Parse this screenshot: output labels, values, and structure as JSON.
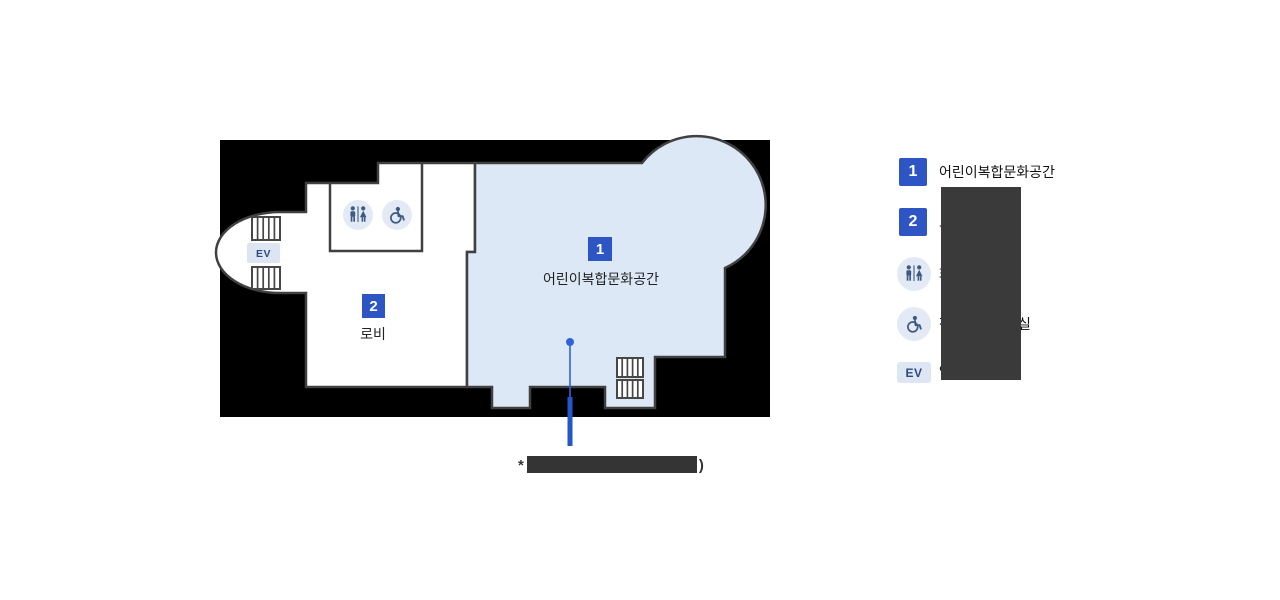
{
  "plan": {
    "area1": {
      "badge": "1",
      "label": "어린이복합문화공간"
    },
    "area2": {
      "badge": "2",
      "label": "로비"
    },
    "elevator_label": "EV"
  },
  "legend": {
    "items": [
      {
        "badge": "1",
        "label": "어린이복합문화공간"
      },
      {
        "badge": "2",
        "label_fragment": "로"
      },
      {
        "icon": "restroom-icon",
        "label_fragment": "화"
      },
      {
        "icon": "wheelchair-icon",
        "label_fragment": "장",
        "label_fragment_end": "실"
      },
      {
        "badge": "EV",
        "label_fragment": "엘"
      }
    ]
  },
  "annotation": {
    "prefix": "*",
    "suffix": ")"
  },
  "colors": {
    "accent": "#2d56c4",
    "wall": "#404040",
    "blue-fill": "#dce8f5",
    "icon-bg": "#e4eaf5",
    "icon-fg": "#3c5a82",
    "callout": "#2f64d8",
    "redact": "#3a3a3a",
    "ink": "#222222"
  }
}
